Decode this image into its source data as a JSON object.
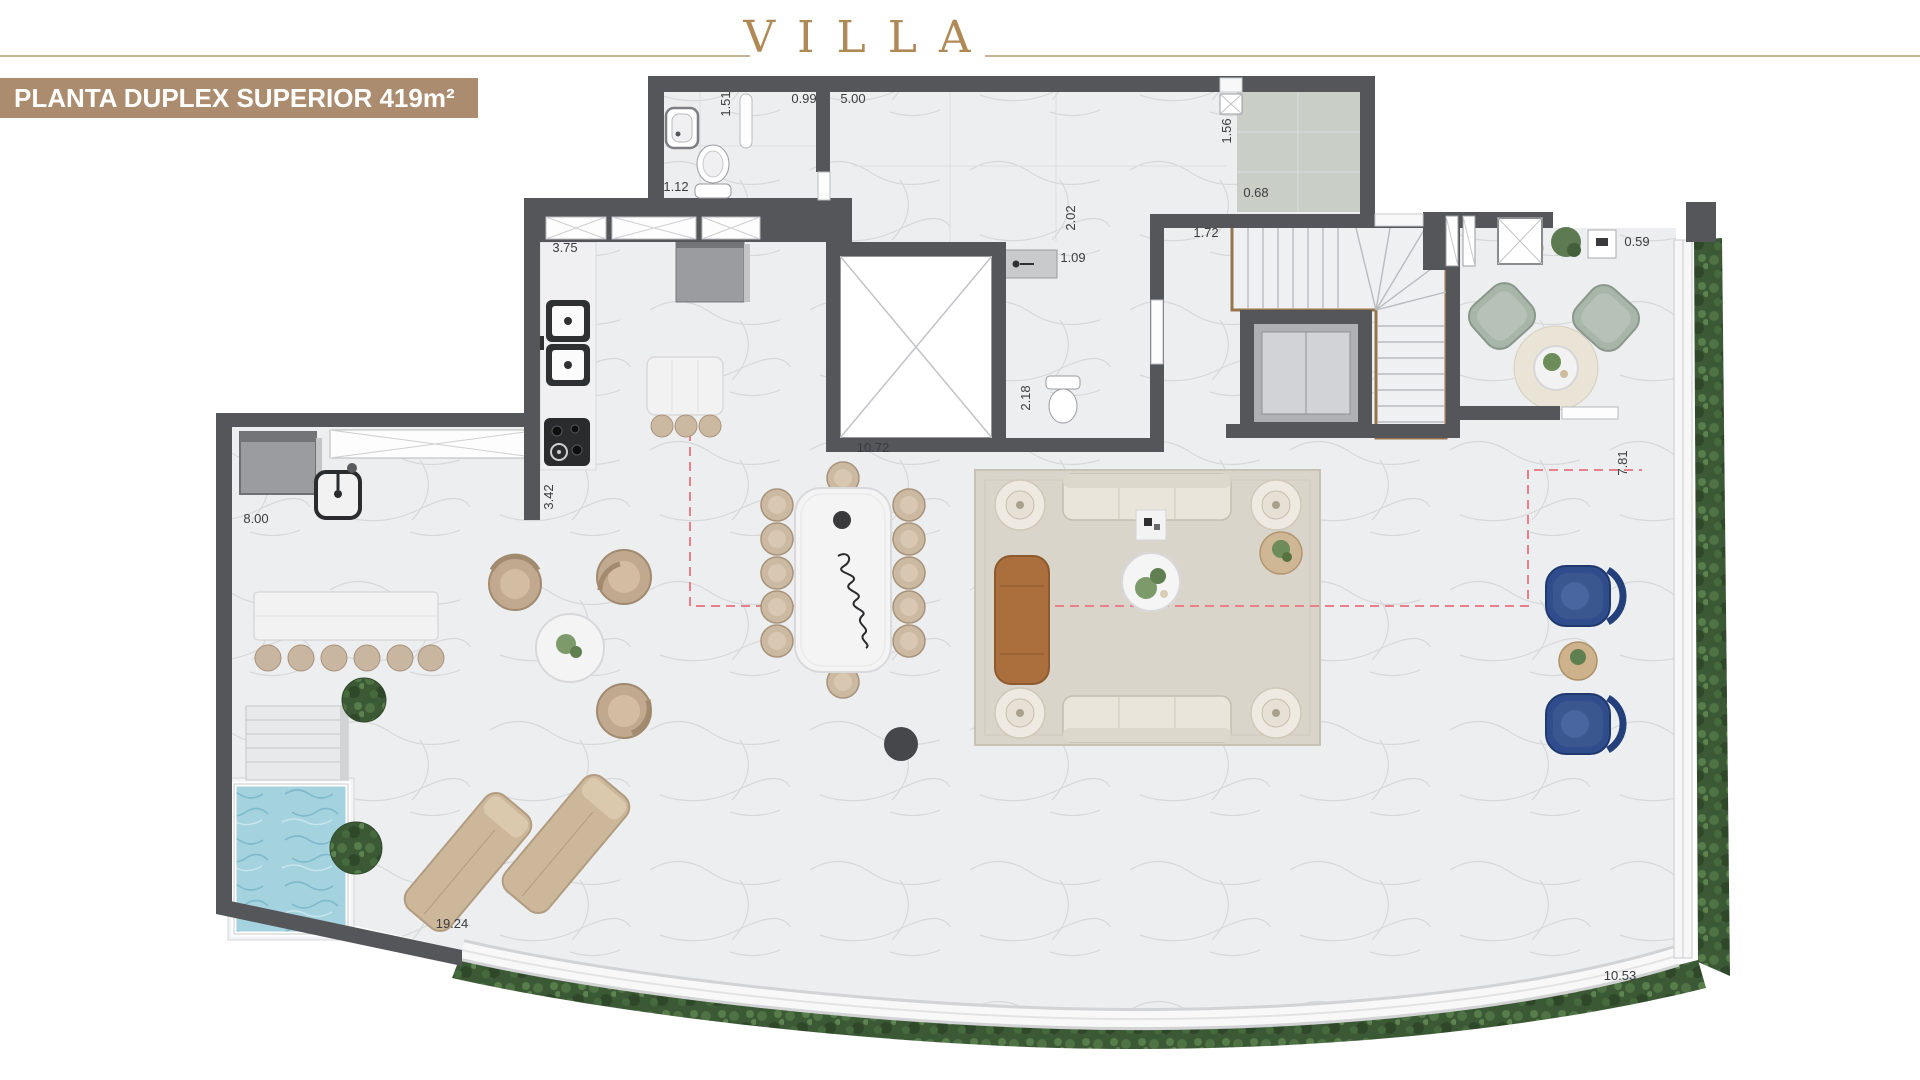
{
  "header": {
    "title": "VILLA"
  },
  "banner": {
    "label": "PLANTA DUPLEX SUPERIOR 419m²"
  },
  "plan": {
    "dimension_labels": [
      {
        "text": "1.51",
        "x": 730,
        "y": 104,
        "rotated": true
      },
      {
        "text": "0.99",
        "x": 804,
        "y": 103,
        "rotated": false
      },
      {
        "text": "5.00",
        "x": 853,
        "y": 103,
        "rotated": false
      },
      {
        "text": "1.12",
        "x": 676,
        "y": 191,
        "rotated": false
      },
      {
        "text": "3.75",
        "x": 565,
        "y": 252,
        "rotated": false
      },
      {
        "text": "1.56",
        "x": 1231,
        "y": 131,
        "rotated": true
      },
      {
        "text": "0.68",
        "x": 1256,
        "y": 197,
        "rotated": false
      },
      {
        "text": "2.02",
        "x": 1075,
        "y": 218,
        "rotated": true
      },
      {
        "text": "1.72",
        "x": 1206,
        "y": 237,
        "rotated": false
      },
      {
        "text": "1.09",
        "x": 1073,
        "y": 262,
        "rotated": false
      },
      {
        "text": "0.59",
        "x": 1637,
        "y": 246,
        "rotated": false
      },
      {
        "text": "2.18",
        "x": 1030,
        "y": 398,
        "rotated": true
      },
      {
        "text": "10.72",
        "x": 873,
        "y": 452,
        "rotated": false
      },
      {
        "text": "3.42",
        "x": 553,
        "y": 497,
        "rotated": true
      },
      {
        "text": "8.00",
        "x": 256,
        "y": 523,
        "rotated": false
      },
      {
        "text": "7.81",
        "x": 1627,
        "y": 463,
        "rotated": true
      },
      {
        "text": "19.24",
        "x": 452,
        "y": 928,
        "rotated": false
      },
      {
        "text": "10.53",
        "x": 1620,
        "y": 980,
        "rotated": false
      }
    ],
    "colors": {
      "gold": "#b08a56",
      "gold-line": "#c9b294",
      "banner-bg": "#ac8c6f",
      "banner-text": "#ffffff",
      "wall": "#55565a",
      "floor": "#edeef0",
      "green-room-floor": "#c9cec6",
      "rug": "#d9d5cb",
      "pool-water": "#a4d2df",
      "hedge": "#3c5936",
      "dash": "#e8808c",
      "wood": "#96744e",
      "blue-chair": "#2f4d8d",
      "leather": "#aa6f3c",
      "tan": "#cbb9a2"
    }
  }
}
